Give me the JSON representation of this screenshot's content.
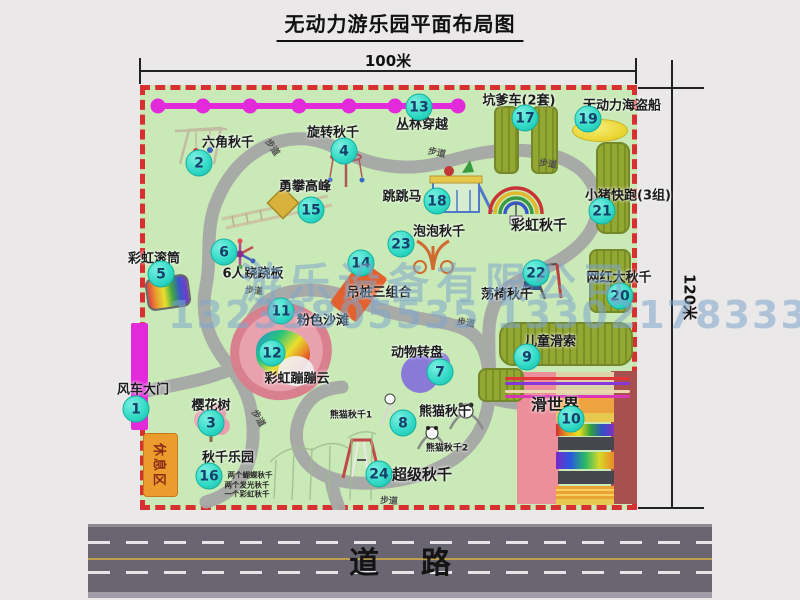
{
  "title": "无动力游乐园平面布局图",
  "dimensions": {
    "width": "100米",
    "height": "120米"
  },
  "road": {
    "label": "道    路"
  },
  "watermark": {
    "line1": "游乐设备有限公司",
    "line2": "13233805535 13302178333"
  },
  "rest_area_label": "休息区",
  "colors": {
    "park_green": "#c9e9b6",
    "border_red": "#d83030",
    "marker_bg": "#2ed9c5",
    "marker_text": "#16406b",
    "magenta": "#e32adb",
    "road_gray": "#696571",
    "watermark_blue": "#7fa6cc",
    "olive_green": "#93a833",
    "rest_orange": "#ec9c2c"
  },
  "attractions": [
    {
      "num": "1",
      "label": "风车大门",
      "mx": 136,
      "my": 409,
      "lx": 143,
      "ly": 388
    },
    {
      "num": "2",
      "label": "六角秋千",
      "mx": 199,
      "my": 163,
      "lx": 228,
      "ly": 141
    },
    {
      "num": "3",
      "label": "樱花树",
      "mx": 211,
      "my": 423,
      "lx": 211,
      "ly": 404
    },
    {
      "num": "4",
      "label": "旋转秋千",
      "mx": 344,
      "my": 151,
      "lx": 333,
      "ly": 131
    },
    {
      "num": "5",
      "label": "彩虹滚筒",
      "mx": 161,
      "my": 274,
      "lx": 154,
      "ly": 257
    },
    {
      "num": "6",
      "label": "6人跷跷板",
      "mx": 224,
      "my": 252,
      "lx": 253,
      "ly": 272
    },
    {
      "num": "7",
      "label": "动物转盘",
      "mx": 440,
      "my": 372,
      "lx": 417,
      "ly": 351
    },
    {
      "num": "8",
      "label": "熊猫秋千",
      "mx": 403,
      "my": 423,
      "lx": 445,
      "ly": 410
    },
    {
      "num": "9",
      "label": "儿童滑索",
      "mx": 527,
      "my": 357,
      "lx": 550,
      "ly": 340
    },
    {
      "num": "10",
      "label": "滑世界",
      "mx": 571,
      "my": 419,
      "lx": 555,
      "ly": 403,
      "ls": 16
    },
    {
      "num": "11",
      "label": "粉色沙滩",
      "mx": 281,
      "my": 311,
      "lx": 323,
      "ly": 319
    },
    {
      "num": "12",
      "label": "彩虹蹦蹦云",
      "mx": 272,
      "my": 353,
      "lx": 297,
      "ly": 377
    },
    {
      "num": "13",
      "label": "丛林穿越",
      "mx": 419,
      "my": 107,
      "lx": 422,
      "ly": 123
    },
    {
      "num": "14",
      "label": "吊桩三组合",
      "mx": 361,
      "my": 263,
      "lx": 379,
      "ly": 291
    },
    {
      "num": "15",
      "label": "勇攀高峰",
      "mx": 311,
      "my": 210,
      "lx": 305,
      "ly": 185
    },
    {
      "num": "16",
      "label": "秋千乐园",
      "mx": 209,
      "my": 476,
      "lx": 228,
      "ly": 456,
      "notes": [
        {
          "text": "两个蝴蝶秋千",
          "x": 250,
          "y": 475
        },
        {
          "text": "两个发光秋千",
          "x": 247,
          "y": 485
        },
        {
          "text": "一个彩虹秋千",
          "x": 247,
          "y": 494
        }
      ]
    },
    {
      "num": "17",
      "label": "坑爹车(2套)",
      "mx": 525,
      "my": 118,
      "lx": 519,
      "ly": 99
    },
    {
      "num": "18",
      "label": "跳跳马",
      "mx": 437,
      "my": 201,
      "lx": 402,
      "ly": 195
    },
    {
      "num": "19",
      "label": "无动力海盗船",
      "mx": 588,
      "my": 119,
      "lx": 622,
      "ly": 104
    },
    {
      "num": "20",
      "label": "网红大秋千",
      "mx": 620,
      "my": 296,
      "lx": 619,
      "ly": 276
    },
    {
      "num": "21",
      "label": "小猪快跑(3组)",
      "mx": 602,
      "my": 211,
      "lx": 628,
      "ly": 194
    },
    {
      "num": "22",
      "label": "荡椅秋千",
      "mx": 536,
      "my": 273,
      "lx": 507,
      "ly": 293
    },
    {
      "num": "23",
      "label": "泡泡秋千",
      "mx": 401,
      "my": 244,
      "lx": 439,
      "ly": 230
    },
    {
      "num": "24",
      "label": "超级秋千",
      "mx": 379,
      "my": 474,
      "lx": 422,
      "ly": 474,
      "ls": 15
    }
  ],
  "extra_labels": [
    {
      "text": "彩虹秋千",
      "x": 539,
      "y": 225,
      "size": 14
    },
    {
      "text": "熊猫秋千1",
      "x": 351,
      "y": 414,
      "size": 9
    },
    {
      "text": "熊猫秋千2",
      "x": 447,
      "y": 447,
      "size": 9
    }
  ],
  "path_labels": [
    {
      "text": "步道",
      "x": 273,
      "y": 147,
      "rot": 55
    },
    {
      "text": "步道",
      "x": 437,
      "y": 152,
      "rot": 12
    },
    {
      "text": "步道",
      "x": 548,
      "y": 163,
      "rot": 8
    },
    {
      "text": "步道",
      "x": 254,
      "y": 290,
      "rot": 4
    },
    {
      "text": "步道",
      "x": 466,
      "y": 322,
      "rot": 8
    },
    {
      "text": "步道",
      "x": 259,
      "y": 418,
      "rot": 60
    },
    {
      "text": "步道",
      "x": 389,
      "y": 500,
      "rot": 3
    }
  ]
}
